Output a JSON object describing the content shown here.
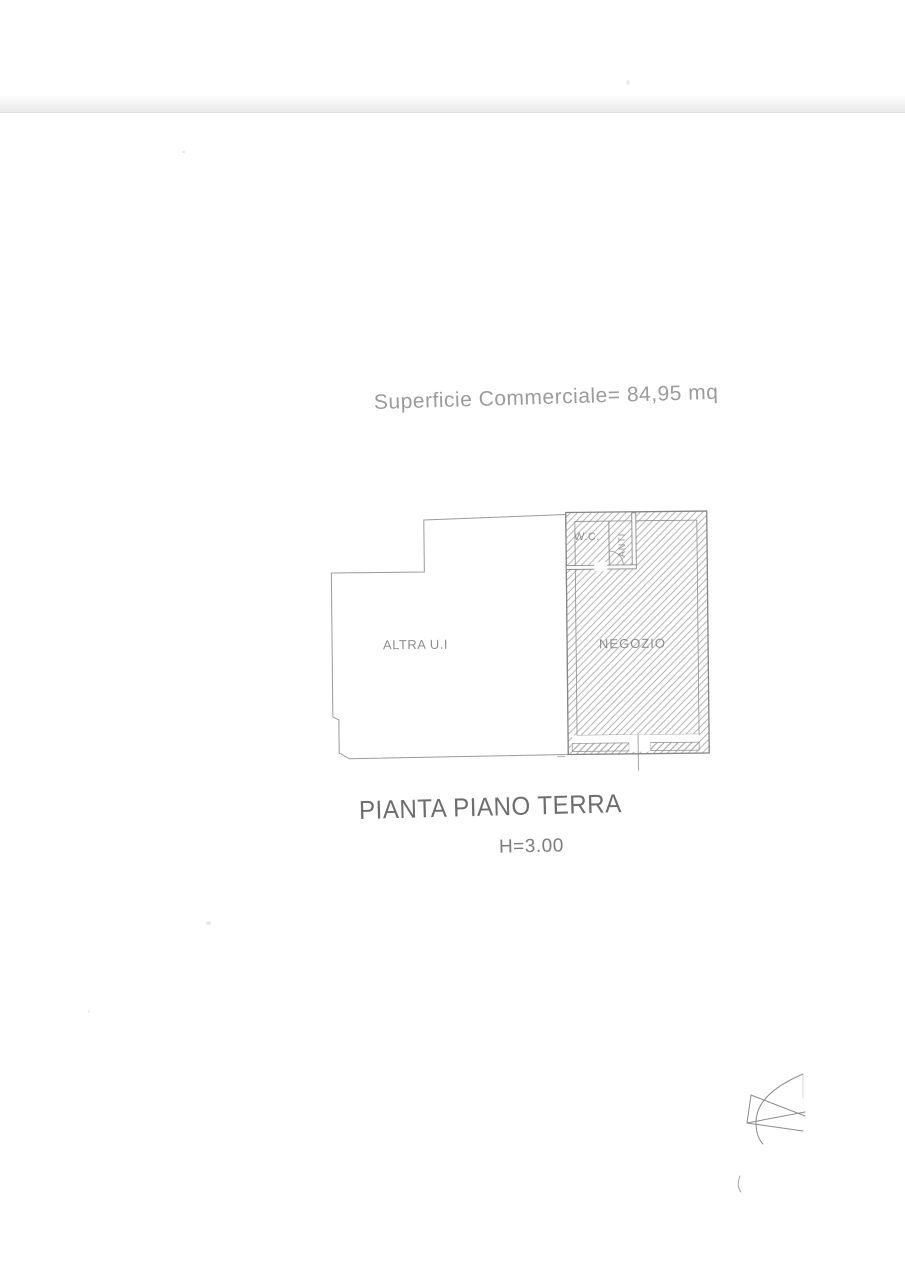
{
  "document": {
    "area_label": "Superficie Commerciale= 84,95 mq",
    "plan_title": "PIANTA PIANO TERRA",
    "height_label": "H=3.00",
    "rooms": {
      "altra_ui": "ALTRA U.I",
      "negozio": "NEGOZIO",
      "wc": "W.C.",
      "anti": "ANTI"
    },
    "colors": {
      "outline_line": "#949494",
      "hatch_line": "#a6a6a6",
      "scribble_line": "#8c8c8c",
      "text_light": "#9b9b9b",
      "text_dark": "#6d6d6d",
      "scan_band": "#e9e9e9"
    }
  }
}
